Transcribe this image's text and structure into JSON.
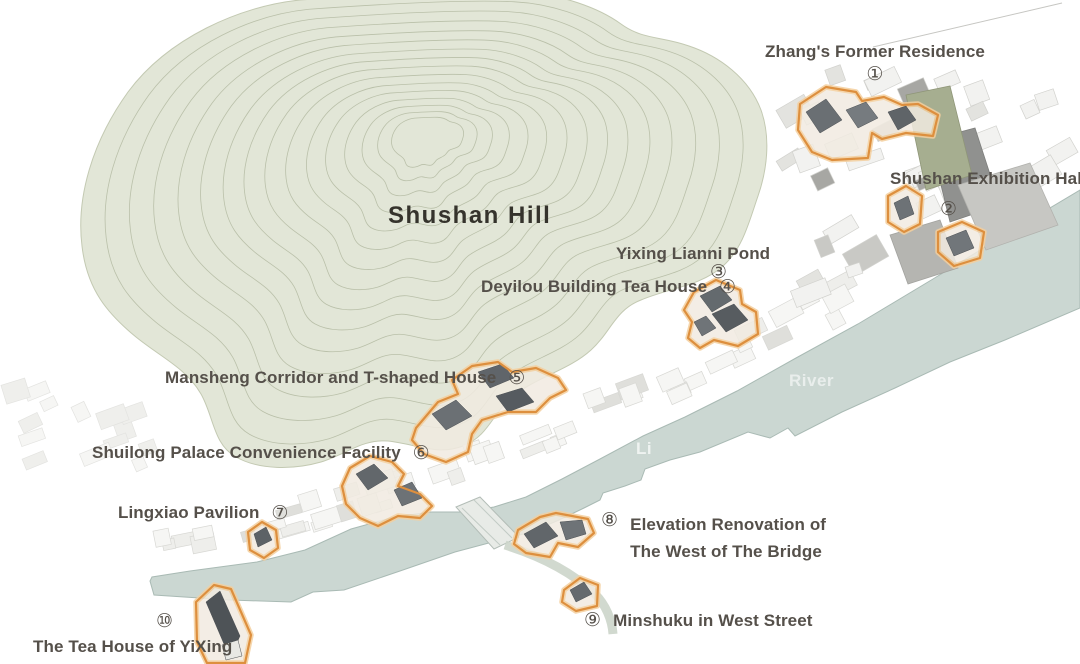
{
  "map": {
    "hill": {
      "label": "Shushan Hill"
    },
    "river": {
      "word1": "Li",
      "word2": "River"
    },
    "sites": [
      {
        "num": "①",
        "label": "Zhang's Former Residence"
      },
      {
        "num": "②",
        "label": "Shushan Exhibition Hall"
      },
      {
        "num": "③",
        "label": "Yixing Lianni Pond"
      },
      {
        "num": "④",
        "label": "Deyilou Building Tea House"
      },
      {
        "num": "⑤",
        "label": "Mansheng Corridor and T-shaped House"
      },
      {
        "num": "⑥",
        "label": "Shuilong Palace Convenience Facility"
      },
      {
        "num": "⑦",
        "label": "Lingxiao Pavilion"
      },
      {
        "num": "⑧",
        "label": "Elevation Renovation of The West of The Bridge",
        "lines": [
          "Elevation Renovation of",
          "The West of The Bridge"
        ]
      },
      {
        "num": "⑨",
        "label": "Minshuku in West Street"
      },
      {
        "num": "⑩",
        "label": "The Tea House of YiXing"
      }
    ],
    "colors": {
      "highlight_outline": "#dd8f3e",
      "highlight_halo": "#f4cf9e",
      "hill_fill": "#e2e6d7",
      "contour_line": "#a9b096",
      "river_fill": "#cbd7d2",
      "label_text": "#55504a",
      "dark_roof": "#60656a"
    }
  }
}
